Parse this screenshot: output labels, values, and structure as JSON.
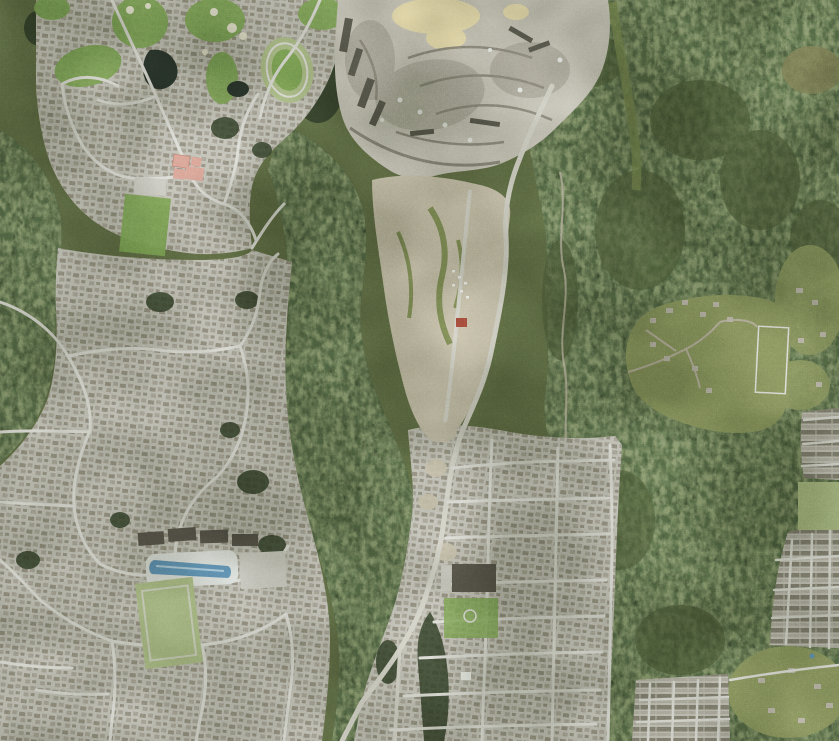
{
  "view": {
    "type": "satellite-aerial-imagery",
    "width_px": 839,
    "height_px": 741
  },
  "features": {
    "map": "Aerial satellite view: suburban neighbourhoods, gravel quarry, construction site and conifer forest",
    "forest": "conifer forest",
    "brush": "light brush and deciduous patches",
    "quarry": "gravel quarry",
    "quarry_sand": "pale sand stockpile",
    "construction": "cleared construction site",
    "golf": "golf course fairways",
    "track": "oval running track",
    "pond": "pond",
    "bunker": "sand bunker",
    "residential": "residential neighbourhood",
    "rowhouses": "rowhouse blocks",
    "rural": "rural acreage clearing",
    "rural_house": "rural house",
    "fence_field": "fenced paddock",
    "school_red": "school with red roofs",
    "school_dark": "school with dark roof",
    "sports_field": "sports field",
    "pool": "outdoor swimming pool",
    "pool_deck": "pool deck",
    "condos": "condominium rows",
    "parking": "parking lot",
    "road": "arterial road",
    "street": "residential street",
    "dirt_road": "dirt road",
    "creek": "creek ravine",
    "powerline": "power line clearing",
    "tree_clump": "tree clump",
    "white_building": "light-roofed building"
  },
  "colors": {
    "base_green": "#5f6c45",
    "forest_dark": "#36422c",
    "forest_mid": "#4c5a38",
    "forest_light": "#76854f",
    "grass_rural": "#87935e",
    "golf_green": "#7ca355",
    "field_pale": "#aabc85",
    "sand": "#e9e6d2",
    "pond_dark": "#2a352c",
    "residential": "#c1c0b6",
    "street": "#dcdcd6",
    "road": "#d2d1c7",
    "house_dark": "#8a8678",
    "house_mid": "#a29d90",
    "house_light": "#b7b2a6",
    "rowhouse_dark": "#7e7a6c",
    "rowhouse_light": "#b0aca0",
    "quarry_light": "#c8c5b9",
    "quarry_mid": "#adaa9d",
    "quarry_dark": "#8b887c",
    "quarry_shadow": "#5a594f",
    "quarry_cream": "#ecdfae",
    "construction": "#c6bfa9",
    "construction_green": "#7d8a55",
    "school_red": "#d8a294",
    "school_red_dark": "#c08273",
    "red_building": "#a34a3a",
    "pool_deck": "#dde1dd",
    "pool_water": "#5e8fb4",
    "pool_water_light": "#a9cadd",
    "dark_roof": "#57544b",
    "parking": "#c9c8c0",
    "white": "#eceee9",
    "creek": "#b5ae9c",
    "brown_clearing": "#7b7b54"
  }
}
